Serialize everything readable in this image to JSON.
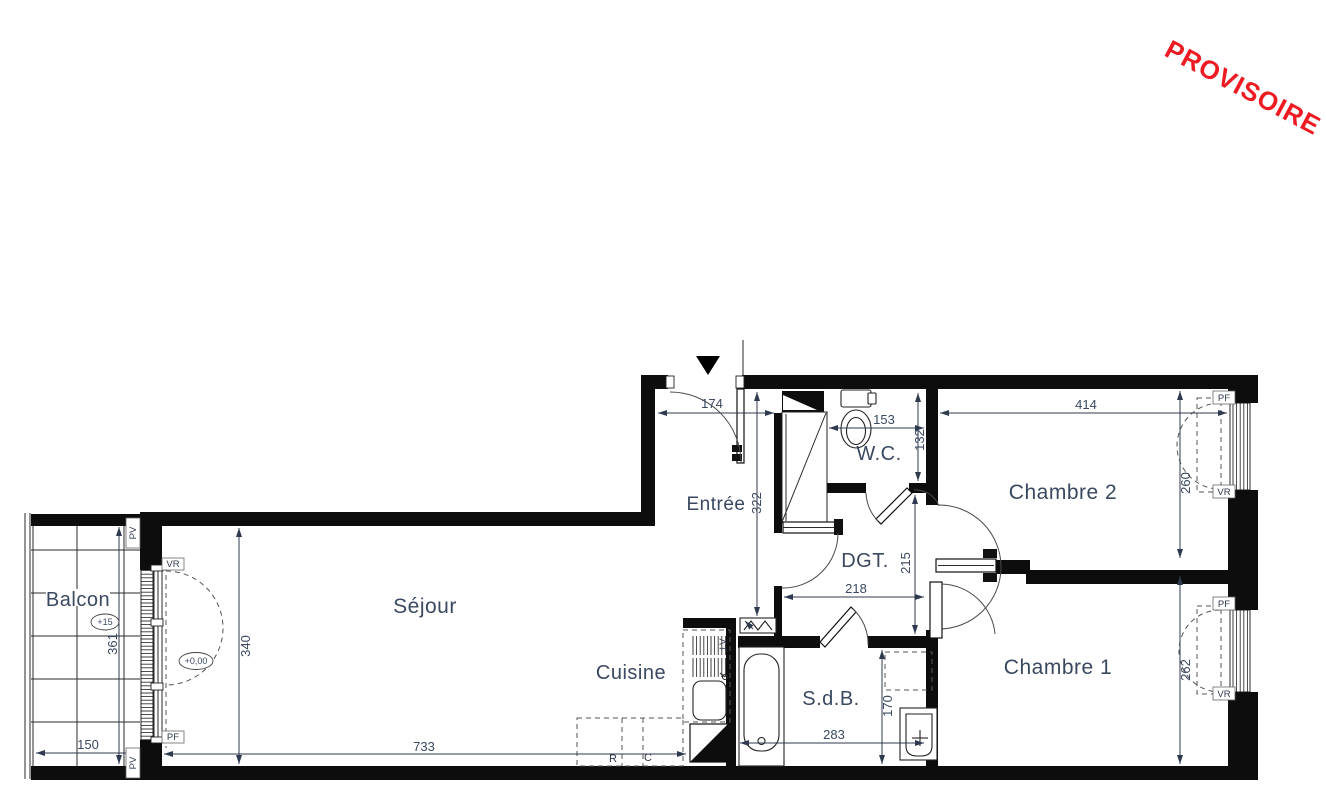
{
  "watermark": {
    "label": "PROVISOIRE"
  },
  "rooms": {
    "balcon": "Balcon",
    "sejour": "Séjour",
    "cuisine": "Cuisine",
    "entree": "Entrée",
    "wc": "W.C.",
    "dgt": "DGT.",
    "chambre2": "Chambre 2",
    "chambre1": "Chambre 1",
    "sdb": "S.d.B."
  },
  "dims": {
    "entree_w": "174",
    "entree_h": "322",
    "wc_w": "153",
    "wc_h": "132",
    "ch2_w": "414",
    "ch2_h": "260",
    "dgt_w": "218",
    "dgt_h": "215",
    "ch1_h": "262",
    "sdb_w": "283",
    "sdb_h": "170",
    "sejour_h": "340",
    "sejour_w": "733",
    "balcon_w": "150",
    "balcon_h": "361"
  },
  "levels": {
    "balcon": "+15",
    "interieur": "+0,00"
  },
  "tags": {
    "pf": "PF",
    "vr": "VR",
    "pv": "PV",
    "lv": "LV",
    "refrigerateur": "R",
    "cuisiniere": "C"
  },
  "colors": {
    "wall": "#0d0d0d",
    "label": "#3a4860",
    "line": "#2f3a4f",
    "watermark": "#ee1b22"
  }
}
